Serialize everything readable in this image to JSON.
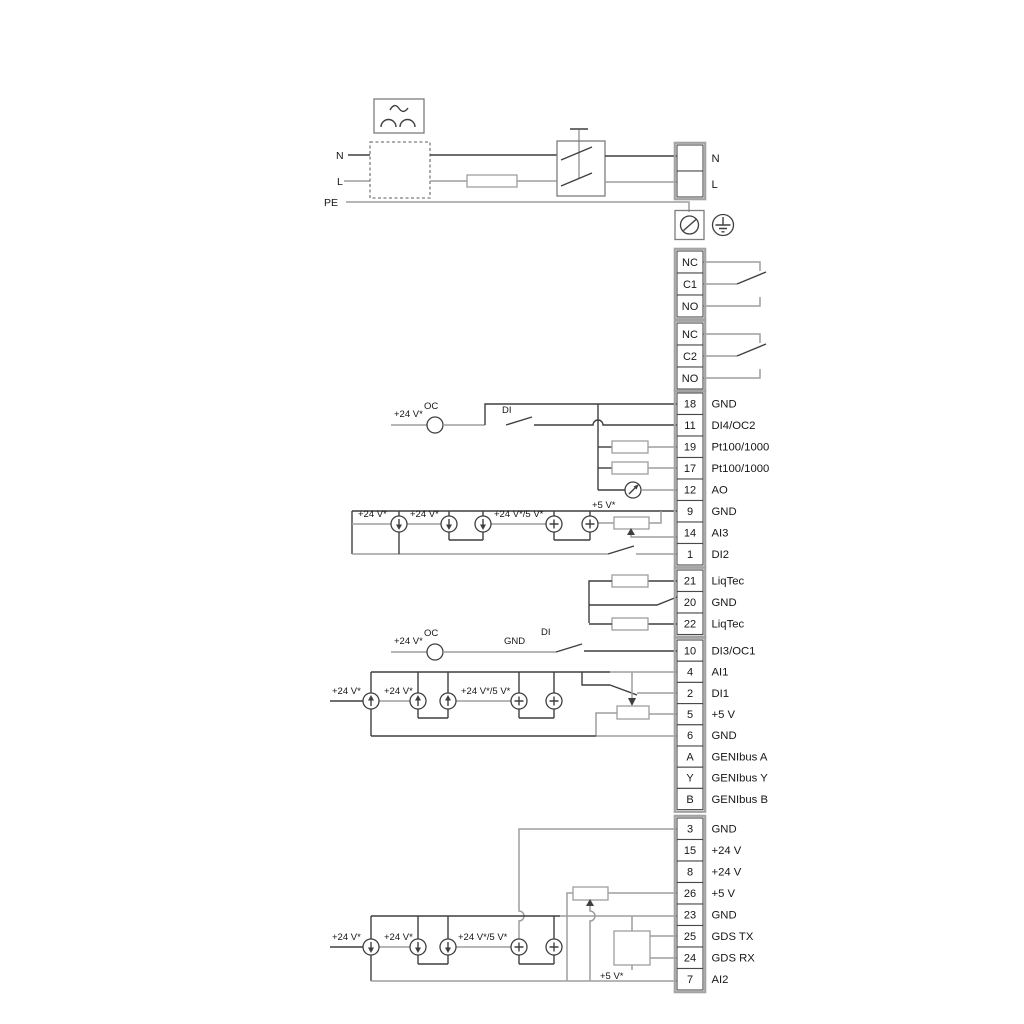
{
  "top": {
    "n": "N",
    "l": "L",
    "pe": "PE"
  },
  "labels": {
    "v24": "+24 V*",
    "v24v5": "+24 V*/5 V*",
    "v5": "+5 V*",
    "oc": "OC",
    "di": "DI",
    "gnd": "GND"
  },
  "terminal_groups": [
    {
      "name": "mains-output",
      "rows": [
        {
          "id": "",
          "label": "N"
        },
        {
          "id": "",
          "label": "L"
        }
      ]
    },
    {
      "name": "relay-1",
      "rows": [
        {
          "id": "NC",
          "label": ""
        },
        {
          "id": "C1",
          "label": ""
        },
        {
          "id": "NO",
          "label": ""
        }
      ]
    },
    {
      "name": "relay-2",
      "rows": [
        {
          "id": "NC",
          "label": ""
        },
        {
          "id": "C2",
          "label": ""
        },
        {
          "id": "NO",
          "label": ""
        }
      ]
    },
    {
      "name": "io-top",
      "rows": [
        {
          "id": "18",
          "label": "GND"
        },
        {
          "id": "11",
          "label": "DI4/OC2"
        },
        {
          "id": "19",
          "label": "Pt100/1000"
        },
        {
          "id": "17",
          "label": "Pt100/1000"
        },
        {
          "id": "12",
          "label": "AO"
        },
        {
          "id": "9",
          "label": "GND"
        },
        {
          "id": "14",
          "label": "AI3"
        },
        {
          "id": "1",
          "label": "DI2"
        }
      ]
    },
    {
      "name": "liqtec",
      "rows": [
        {
          "id": "21",
          "label": "LiqTec"
        },
        {
          "id": "20",
          "label": "GND"
        },
        {
          "id": "22",
          "label": "LiqTec"
        }
      ]
    },
    {
      "name": "io-mid",
      "rows": [
        {
          "id": "10",
          "label": "DI3/OC1"
        },
        {
          "id": "4",
          "label": "AI1"
        },
        {
          "id": "2",
          "label": "DI1"
        },
        {
          "id": "5",
          "label": "+5 V"
        },
        {
          "id": "6",
          "label": "GND"
        },
        {
          "id": "A",
          "label": "GENIbus A"
        },
        {
          "id": "Y",
          "label": "GENIbus Y"
        },
        {
          "id": "B",
          "label": "GENIbus B"
        }
      ]
    },
    {
      "name": "io-bottom",
      "rows": [
        {
          "id": "3",
          "label": "GND"
        },
        {
          "id": "15",
          "label": "+24 V"
        },
        {
          "id": "8",
          "label": "+24 V"
        },
        {
          "id": "26",
          "label": "+5 V"
        },
        {
          "id": "23",
          "label": "GND"
        },
        {
          "id": "25",
          "label": "GDS TX"
        },
        {
          "id": "24",
          "label": "GDS RX"
        },
        {
          "id": "7",
          "label": "AI2"
        }
      ]
    }
  ]
}
